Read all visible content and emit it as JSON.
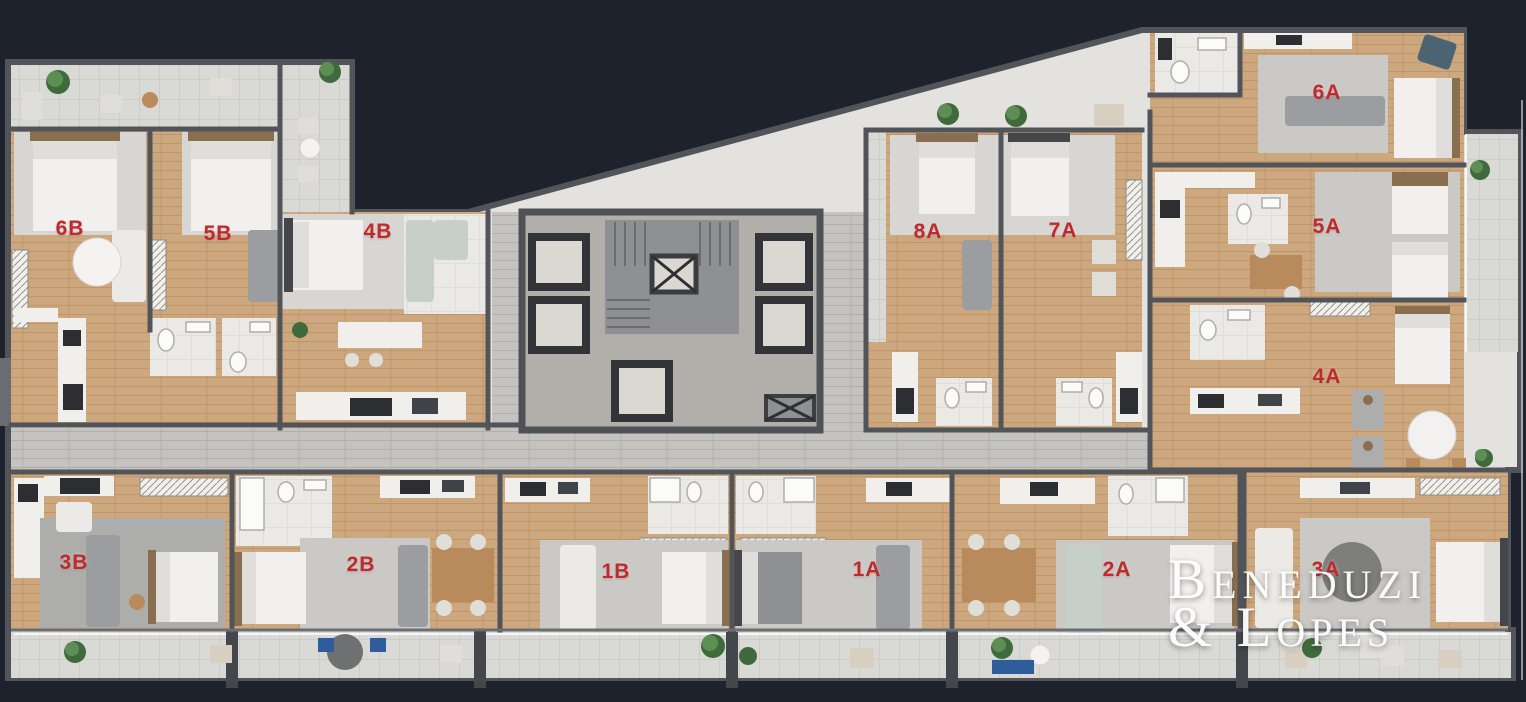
{
  "scene": {
    "type": "residential-floor-plan-render",
    "background_color": "#1e222c",
    "unit_label_color": "#bf2a2c",
    "canvas": {
      "width": 1526,
      "height": 702
    }
  },
  "watermark": {
    "line1": "Beneduzi",
    "line2": "& Lopes"
  },
  "units": [
    {
      "id": "6B",
      "x": 70,
      "y": 229
    },
    {
      "id": "5B",
      "x": 218,
      "y": 234
    },
    {
      "id": "4B",
      "x": 378,
      "y": 232
    },
    {
      "id": "8A",
      "x": 928,
      "y": 232
    },
    {
      "id": "7A",
      "x": 1063,
      "y": 231
    },
    {
      "id": "6A",
      "x": 1327,
      "y": 93
    },
    {
      "id": "5A",
      "x": 1327,
      "y": 227
    },
    {
      "id": "4A",
      "x": 1327,
      "y": 377
    },
    {
      "id": "3A",
      "x": 1326,
      "y": 570
    },
    {
      "id": "3B",
      "x": 74,
      "y": 563
    },
    {
      "id": "2B",
      "x": 361,
      "y": 565
    },
    {
      "id": "1B",
      "x": 616,
      "y": 572
    },
    {
      "id": "1A",
      "x": 867,
      "y": 570
    },
    {
      "id": "2A",
      "x": 1117,
      "y": 570
    }
  ]
}
